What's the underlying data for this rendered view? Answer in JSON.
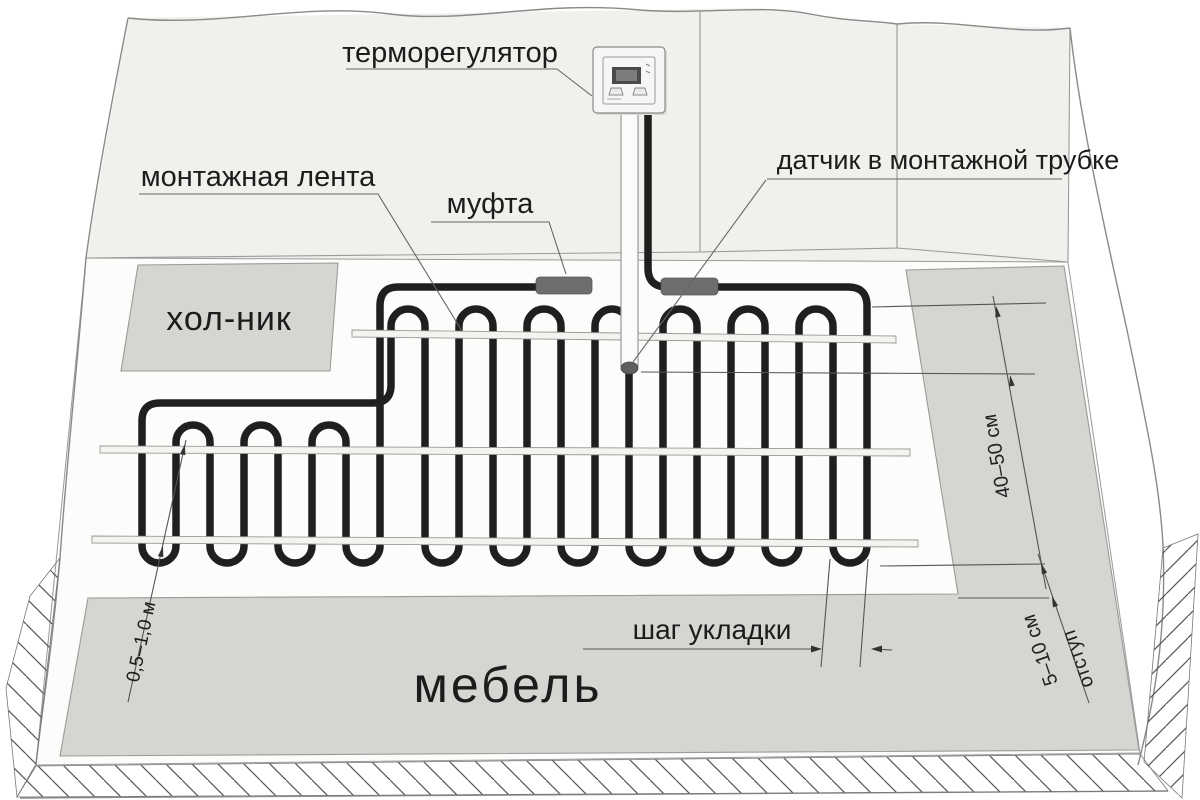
{
  "labels": {
    "thermostat": "терморегулятор",
    "mounting_tape": "монтажная лента",
    "coupling": "муфта",
    "sensor": "датчик в монтажной трубке",
    "fridge": "хол-ник",
    "furniture": "мебель",
    "laying_step": "шаг укладки"
  },
  "dimensions": {
    "sensor_distance": "40–50 см",
    "offset_value": "5–10 см",
    "offset_word": "отступ",
    "cable_to_furniture": "0,5–1,0 м"
  },
  "colors": {
    "cable": "#1f1f1f",
    "coupling": "#6e6e6e",
    "area_fill": "#d5d5d2",
    "wall_fill": "#f0f0ed",
    "floor_fill": "#fcfcfa",
    "tape_fill": "#f3f3f0"
  }
}
